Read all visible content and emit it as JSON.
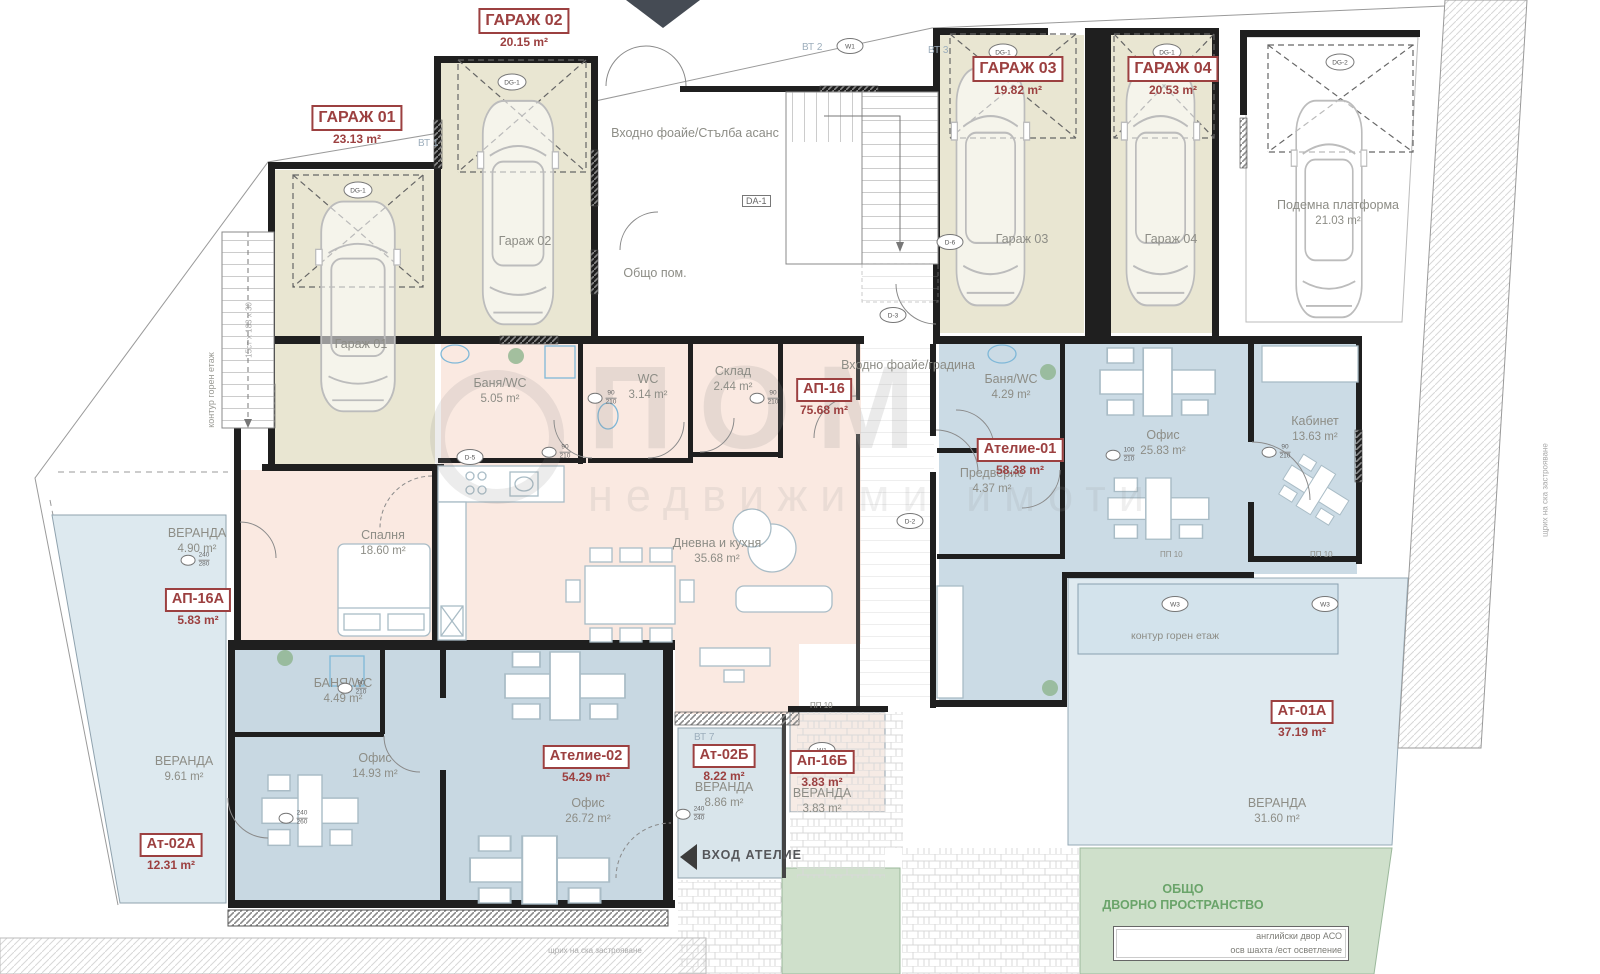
{
  "palette": {
    "garage_fill": "#e9e6d2",
    "apartment_fill": "#fae9e1",
    "office_fill": "#cbdbe5",
    "veranda_fill": "#dde9ef",
    "yard_green": "#cfe0cb",
    "label_red": "#9c4040",
    "text_gray": "#8d8d86",
    "wall_black": "#1f1f1f"
  },
  "units": {
    "garage01": {
      "title": "ГАРАЖ 01",
      "area": "23.13 m²"
    },
    "garage02": {
      "title": "ГАРАЖ 02",
      "area": "20.15 m²"
    },
    "garage03": {
      "title": "ГАРАЖ 03",
      "area": "19.82 m²"
    },
    "garage04": {
      "title": "ГАРАЖ 04",
      "area": "20.53 m²"
    },
    "ap16": {
      "title": "АП-16",
      "area": "75.68 m²"
    },
    "atelie01": {
      "title": "Ателие-01",
      "area": "58.38 m²"
    },
    "ap16a": {
      "title": "АП-16А",
      "area": "5.83 m²"
    },
    "at02a": {
      "title": "Ат-02А",
      "area": "12.31 m²"
    },
    "atelie02": {
      "title": "Ателие-02",
      "area": "54.29 m²"
    },
    "at02b": {
      "title": "Ат-02Б",
      "area": "8.22 m²"
    },
    "ap16b": {
      "title": "Ап-16Б",
      "area": "3.83 m²"
    },
    "at01a": {
      "title": "Ат-01А",
      "area": "37.19 m²"
    }
  },
  "rooms": {
    "garage01": "Гараж 01",
    "garage02": "Гараж 02",
    "garage03": "Гараж 03",
    "garage04": "Гараж 04",
    "platform": {
      "name": "Подемна платформа",
      "area": "21.03 m²"
    },
    "entry_foyer": "Входно фоайе/Стълба асанс",
    "common_room": "Общо пом.",
    "entry_garden": "Входно фоайе/градина",
    "bath1": {
      "name": "Баня/WC",
      "area": "5.05 m²"
    },
    "wc": {
      "name": "WC",
      "area": "3.14 m²"
    },
    "storage": {
      "name": "Склад",
      "area": "2.44 m²"
    },
    "bedroom": {
      "name": "Спалня",
      "area": "18.60 m²"
    },
    "living": {
      "name": "Дневна и кухня",
      "area": "35.68 m²"
    },
    "bath2": {
      "name": "Баня/WC",
      "area": "4.29 m²"
    },
    "vestibule": {
      "name": "Предверие",
      "area": "4.37 m²"
    },
    "office1": {
      "name": "Офис",
      "area": "25.83 m²"
    },
    "cabinet": {
      "name": "Кабинет",
      "area": "13.63 m²"
    },
    "veranda_490": {
      "name": "ВЕРАНДА",
      "area": "4.90 m²"
    },
    "veranda_961": {
      "name": "ВЕРАНДА",
      "area": "9.61 m²"
    },
    "bath3": {
      "name": "БАНЯ/WC",
      "area": "4.49 m²"
    },
    "office2": {
      "name": "Офис",
      "area": "14.93 m²"
    },
    "office3": {
      "name": "Офис",
      "area": "26.72 m²"
    },
    "veranda_886": {
      "name": "ВЕРАНДА",
      "area": "8.86 m²"
    },
    "veranda_383": {
      "name": "ВЕРАНДА",
      "area": "3.83 m²"
    },
    "veranda_3160": {
      "name": "ВЕРАНДА",
      "area": "31.60 m²"
    }
  },
  "annotations": {
    "upper_floor_contour": "контур горен етаж",
    "atelier_entrance": "ВХОД АТЕЛИЕ",
    "yard_line1": "ОБЩО",
    "yard_line2": "ДВОРНО ПРОСТРАНСТВО",
    "english_yard_line1": "английски двор АСО",
    "english_yard_line2": "осв шахта /ест осветление",
    "hatch_note": "щрих на ска застрояване",
    "stair_note": "15ст x 183 x 30"
  },
  "tags": {
    "dg1": "DG-1",
    "dg2": "DG-2",
    "da1": "DA-1",
    "d2": "D-2",
    "d3": "D-3",
    "d5": "D-5",
    "d6": "D-6",
    "w1": "W1",
    "w3": "W3",
    "pp10": "ПП 10",
    "vt1": "ВТ 1",
    "vt2": "ВТ 2",
    "vt3": "ВТ 3",
    "vt7": "ВТ 7",
    "dim90": "90",
    "dim100": "100",
    "dim210": "210",
    "dim240": "240",
    "dim260": "260",
    "dim280": "280"
  },
  "watermark": {
    "line1": "ПОМ",
    "line2": "недвижими имоти"
  }
}
